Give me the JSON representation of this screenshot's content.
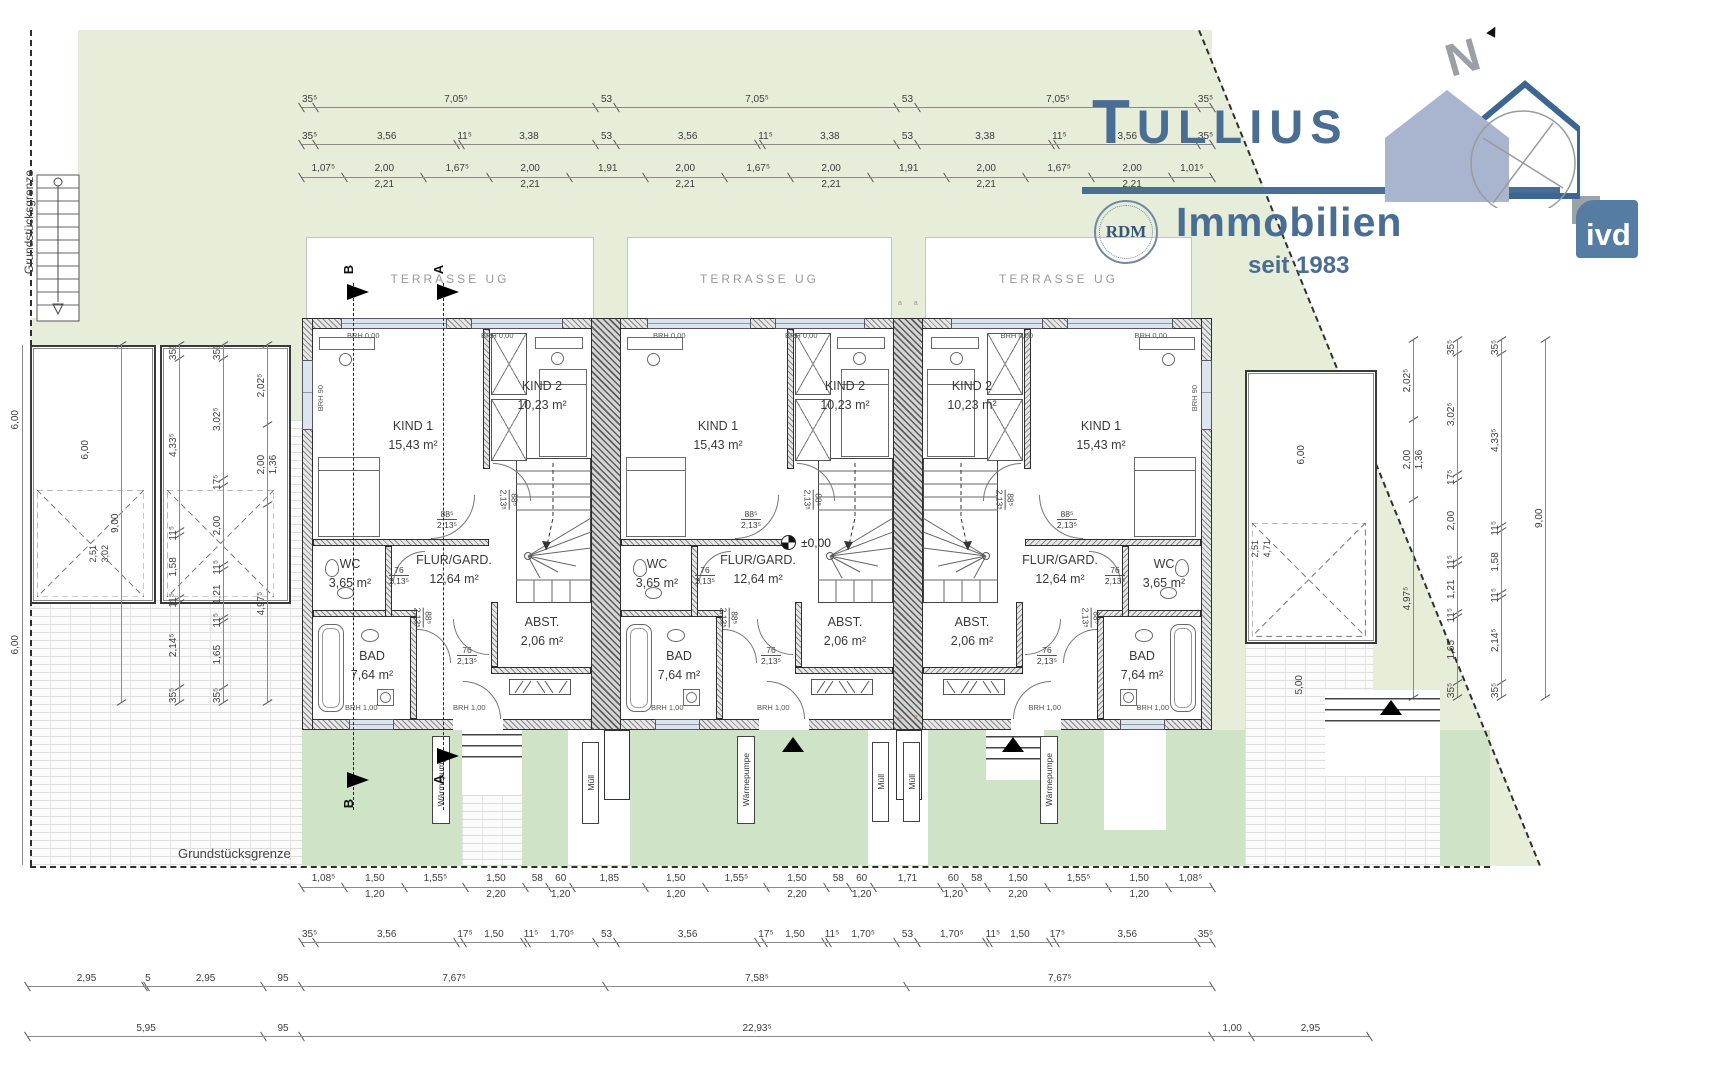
{
  "logo": {
    "title": "TULLIUS",
    "subtitle": "Immobilien",
    "since": "seit 1983",
    "badge_rdm": "RDM",
    "badge_ivd": "ivd",
    "north": "N"
  },
  "colors": {
    "green_light": "#e6edd9",
    "green_dark": "#cfe3c6",
    "logo_blue": "#4a6d94",
    "window_blue": "#dce5ee"
  },
  "boundary": {
    "left_label": "Grundstücksgrenze",
    "bottom_label": "Grundstücksgrenze"
  },
  "terraces": [
    {
      "label": "TERRASSE UG"
    },
    {
      "label": "TERRASSE UG"
    },
    {
      "label": "TERRASSE UG"
    }
  ],
  "rooms": {
    "kind1": {
      "name": "KIND 1",
      "area": "15,43 m²"
    },
    "kind2": {
      "name": "KIND 2",
      "area": "10,23 m²"
    },
    "wc": {
      "name": "WC",
      "area": "3,65 m²"
    },
    "bad": {
      "name": "BAD",
      "area": "7,64 m²"
    },
    "flur": {
      "name": "FLUR/GARD.",
      "area": "12,64 m²"
    },
    "abst": {
      "name": "ABST.",
      "area": "2,06 m²"
    }
  },
  "windows": {
    "top": "BRH 0,00",
    "bottom": "BRH 1,00",
    "side": "BRH 90"
  },
  "doors": {
    "wide": "88⁵",
    "narrow": "76",
    "height": "2,13⁵"
  },
  "level": {
    "eg": "±0,00"
  },
  "outdoor": {
    "wp": "Wärmepumpe",
    "muell": "Müll"
  },
  "sections": {
    "a": "A",
    "b": "B"
  },
  "marks": {
    "aa": "a a"
  },
  "garage": {
    "width_left": "6,00",
    "width_right": "6,00",
    "corner_l1": "2,51",
    "corner_l2": "3,02",
    "corner_r1": "2,51",
    "corner_r2": "4,71",
    "path_right": "5,00"
  },
  "dims": {
    "far_left": [
      "6,00",
      "6,00"
    ],
    "top1": [
      {
        "v": "35⁵",
        "f": 0.355
      },
      {
        "v": "7,05⁵",
        "f": 7.055
      },
      {
        "v": "53",
        "f": 0.53
      },
      {
        "v": "7,05⁵",
        "f": 7.055
      },
      {
        "v": "53",
        "f": 0.53
      },
      {
        "v": "7,05⁵",
        "f": 7.055
      },
      {
        "v": "35⁵",
        "f": 0.355
      }
    ],
    "top2": [
      {
        "v": "35⁵",
        "f": 0.355
      },
      {
        "v": "3,56",
        "f": 3.56
      },
      {
        "v": "11⁵",
        "f": 0.115
      },
      {
        "v": "3,38",
        "f": 3.38
      },
      {
        "v": "53",
        "f": 0.53
      },
      {
        "v": "3,56",
        "f": 3.56
      },
      {
        "v": "11⁵",
        "f": 0.115
      },
      {
        "v": "3,38",
        "f": 3.38
      },
      {
        "v": "53",
        "f": 0.53
      },
      {
        "v": "3,38",
        "f": 3.38
      },
      {
        "v": "11⁵",
        "f": 0.115
      },
      {
        "v": "3,56",
        "f": 3.56
      },
      {
        "v": "35⁵",
        "f": 0.355
      }
    ],
    "top3": [
      {
        "v": "1,07⁵",
        "f": 1.075
      },
      {
        "v": "2,00",
        "b": "2,21",
        "f": 2
      },
      {
        "v": "1,67⁵",
        "f": 1.675
      },
      {
        "v": "2,00",
        "b": "2,21",
        "f": 2
      },
      {
        "v": "1,91",
        "f": 1.91
      },
      {
        "v": "2,00",
        "b": "2,21",
        "f": 2
      },
      {
        "v": "1,67⁵",
        "f": 1.675
      },
      {
        "v": "2,00",
        "b": "2,21",
        "f": 2
      },
      {
        "v": "1,91",
        "f": 1.91
      },
      {
        "v": "2,00",
        "b": "2,21",
        "f": 2
      },
      {
        "v": "1,67⁵",
        "f": 1.675
      },
      {
        "v": "2,00",
        "b": "2,21",
        "f": 2
      },
      {
        "v": "1,01⁵",
        "f": 1.015
      }
    ],
    "bot1": [
      {
        "v": "1,08⁵",
        "f": 1.085
      },
      {
        "v": "1,50",
        "b": "1,20",
        "f": 1.5
      },
      {
        "v": "1,55⁵",
        "f": 1.555
      },
      {
        "v": "1,50",
        "b": "2,20",
        "f": 1.5
      },
      {
        "v": "58",
        "f": 0.58
      },
      {
        "v": "60",
        "b": "1,20",
        "f": 0.6
      },
      {
        "v": "1,85",
        "f": 1.85
      },
      {
        "v": "1,50",
        "b": "1,20",
        "f": 1.5
      },
      {
        "v": "1,55⁵",
        "f": 1.555
      },
      {
        "v": "1,50",
        "b": "2,20",
        "f": 1.5
      },
      {
        "v": "58",
        "f": 0.58
      },
      {
        "v": "60",
        "b": "1,20",
        "f": 0.6
      },
      {
        "v": "1,71",
        "f": 1.71
      },
      {
        "v": "60",
        "b": "1,20",
        "f": 0.6
      },
      {
        "v": "58",
        "f": 0.58
      },
      {
        "v": "1,50",
        "b": "2,20",
        "f": 1.5
      },
      {
        "v": "1,55⁵",
        "f": 1.555
      },
      {
        "v": "1,50",
        "b": "1,20",
        "f": 1.5
      },
      {
        "v": "1,08⁵",
        "f": 1.085
      }
    ],
    "bot2": [
      {
        "v": "35⁵",
        "f": 0.355
      },
      {
        "v": "3,56",
        "f": 3.56
      },
      {
        "v": "17⁵",
        "f": 0.175
      },
      {
        "v": "1,50",
        "f": 1.5
      },
      {
        "v": "11⁵",
        "f": 0.115
      },
      {
        "v": "1,70⁵",
        "f": 1.705
      },
      {
        "v": "53",
        "f": 0.53
      },
      {
        "v": "3,56",
        "f": 3.56
      },
      {
        "v": "17⁵",
        "f": 0.175
      },
      {
        "v": "1,50",
        "f": 1.5
      },
      {
        "v": "11⁵",
        "f": 0.115
      },
      {
        "v": "1,70⁵",
        "f": 1.705
      },
      {
        "v": "53",
        "f": 0.53
      },
      {
        "v": "1,70⁵",
        "f": 1.705
      },
      {
        "v": "11⁵",
        "f": 0.115
      },
      {
        "v": "1,50",
        "f": 1.5
      },
      {
        "v": "17⁵",
        "f": 0.175
      },
      {
        "v": "3,56",
        "f": 3.56
      },
      {
        "v": "35⁵",
        "f": 0.355
      }
    ],
    "bot3": [
      {
        "v": "2,95",
        "f": 2.95
      },
      {
        "v": "5",
        "f": 0.05
      },
      {
        "v": "2,95",
        "f": 2.95
      },
      {
        "v": "95",
        "f": 0.95
      },
      {
        "v": "7,67⁵",
        "f": 7.675
      },
      {
        "v": "7,58⁵",
        "f": 7.585
      },
      {
        "v": "7,67⁵",
        "f": 7.675
      }
    ],
    "bot4": [
      {
        "v": "5,95",
        "f": 5.95
      },
      {
        "v": "95",
        "f": 0.95
      },
      {
        "v": "22,93⁵",
        "f": 22.935
      },
      {
        "v": "1,00",
        "f": 1.0
      },
      {
        "v": "2,95",
        "f": 2.95
      }
    ],
    "right_a": [
      {
        "v": "2,02⁵",
        "f": 2.025
      },
      {
        "v": "2,00",
        "b": "1,36",
        "f": 2
      },
      {
        "v": "4,97⁵",
        "f": 4.975
      }
    ],
    "right_b": [
      {
        "v": "35⁵",
        "f": 0.355
      },
      {
        "v": "3,02⁵",
        "f": 3.025
      },
      {
        "v": "17⁵",
        "f": 0.175
      },
      {
        "v": "2,00",
        "f": 2
      },
      {
        "v": "11⁵",
        "f": 0.115
      },
      {
        "v": "1,21",
        "f": 1.21
      },
      {
        "v": "11⁵",
        "f": 0.115
      },
      {
        "v": "1,65",
        "f": 1.65
      },
      {
        "v": "35⁵",
        "f": 0.355
      }
    ],
    "right_c": [
      {
        "v": "35⁵",
        "f": 0.355
      },
      {
        "v": "4,33⁵",
        "f": 4.335
      },
      {
        "v": "11⁵",
        "f": 0.115
      },
      {
        "v": "1,58",
        "f": 1.58
      },
      {
        "v": "11⁵",
        "f": 0.115
      },
      {
        "v": "2,14⁵",
        "f": 2.145
      },
      {
        "v": "35⁵",
        "f": 0.355
      }
    ],
    "right_d": [
      {
        "v": "9,00",
        "f": 9
      }
    ],
    "left_a": [
      {
        "v": "2,02⁵",
        "f": 2.025
      },
      {
        "v": "2,00",
        "b": "1,36",
        "f": 2
      },
      {
        "v": "4,97⁵",
        "f": 4.975
      }
    ],
    "left_b": [
      {
        "v": "35⁵",
        "f": 0.355
      },
      {
        "v": "3,02⁵",
        "f": 3.025
      },
      {
        "v": "17⁵",
        "f": 0.175
      },
      {
        "v": "2,00",
        "f": 2
      },
      {
        "v": "11⁵",
        "f": 0.115
      },
      {
        "v": "1,21",
        "f": 1.21
      },
      {
        "v": "11⁵",
        "f": 0.115
      },
      {
        "v": "1,65",
        "f": 1.65
      },
      {
        "v": "35⁵",
        "f": 0.355
      }
    ],
    "left_c": [
      {
        "v": "35⁵",
        "f": 0.355
      },
      {
        "v": "4,33⁵",
        "f": 4.335
      },
      {
        "v": "11⁵",
        "f": 0.115
      },
      {
        "v": "1,58",
        "f": 1.58
      },
      {
        "v": "11⁵",
        "f": 0.115
      },
      {
        "v": "2,14⁵",
        "f": 2.145
      },
      {
        "v": "35⁵",
        "f": 0.355
      }
    ],
    "left_d": [
      {
        "v": "9,00",
        "f": 9
      }
    ]
  }
}
